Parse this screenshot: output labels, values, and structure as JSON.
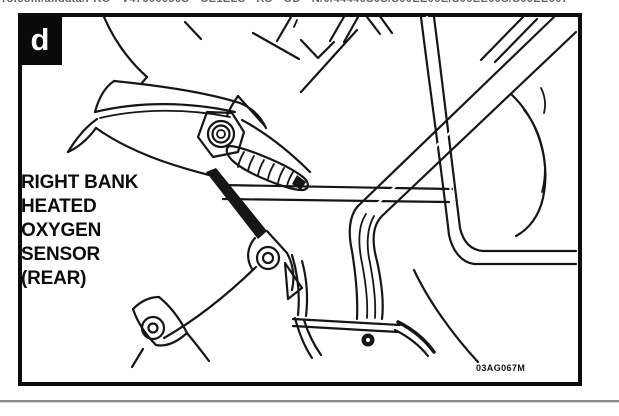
{
  "browser": {
    "clipped_url_text": "rolcom/alldata/PRO - V47600090S - CE1ELS - RS - OD - N/0/44440S0S/S00EE00E/S00EE00S/S00EE007"
  },
  "figure": {
    "panel_label": "d",
    "callout_lines": [
      "RIGHT BANK",
      "HEATED",
      "OXYGEN",
      "SENSOR",
      "(REAR)"
    ],
    "figure_code": "03AG067M",
    "illustration_description": "Black-and-white line art showing the rear heated oxygen sensor of the right bank mounted in the exhaust manifold, with frame pipes crossing behind and mounting bolts below"
  },
  "colors": {
    "line": "#161616",
    "frame_border": "#0c0c0c",
    "panel_label_bg": "#0a0a0a",
    "panel_label_fg": "#ffffff",
    "url_text": "#5b6572",
    "divider": "#8a8a8a"
  }
}
